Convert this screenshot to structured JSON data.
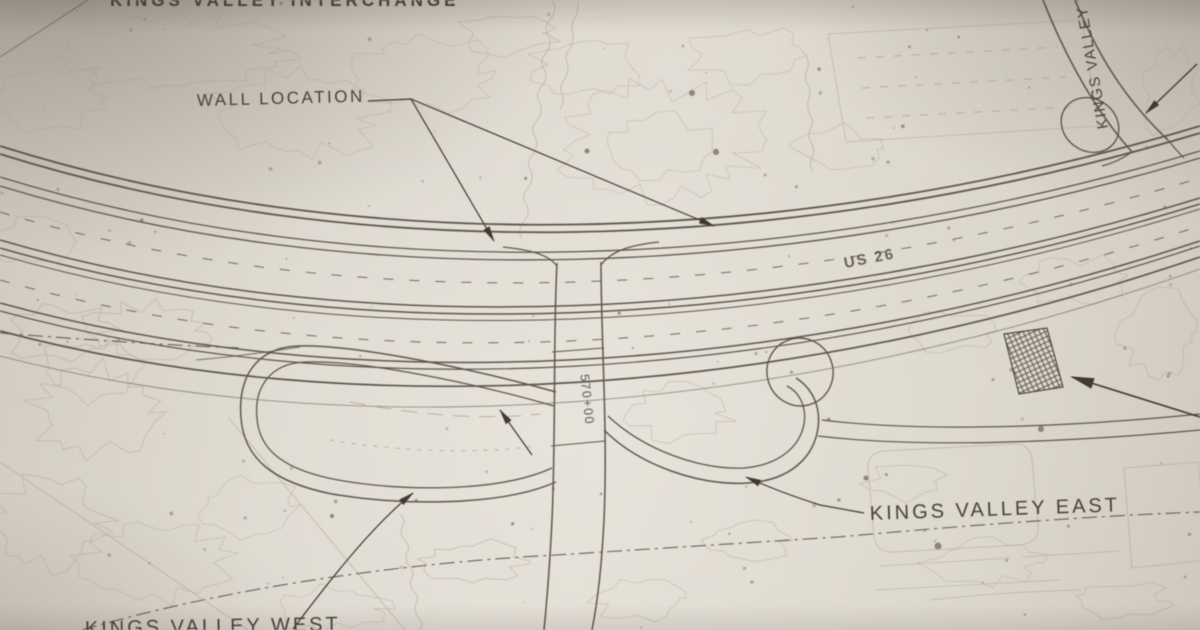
{
  "plan": {
    "labels": {
      "top_partial": "KINGS VALLEY INTERCHANGE",
      "wall_location": "WALL LOCATION",
      "highway_route": "US 26",
      "station": "570+00",
      "kings_valley_drive": "KINGS VALLEY D",
      "kings_valley_east": "KINGS VALLEY EAST",
      "kings_valley_west_partial": "KINGS VALLEY WEST"
    },
    "colors": {
      "paper": "#d9d3c9",
      "ink": "#453f36",
      "roadline": "#5a5349",
      "faint": "#a89d8b"
    }
  }
}
